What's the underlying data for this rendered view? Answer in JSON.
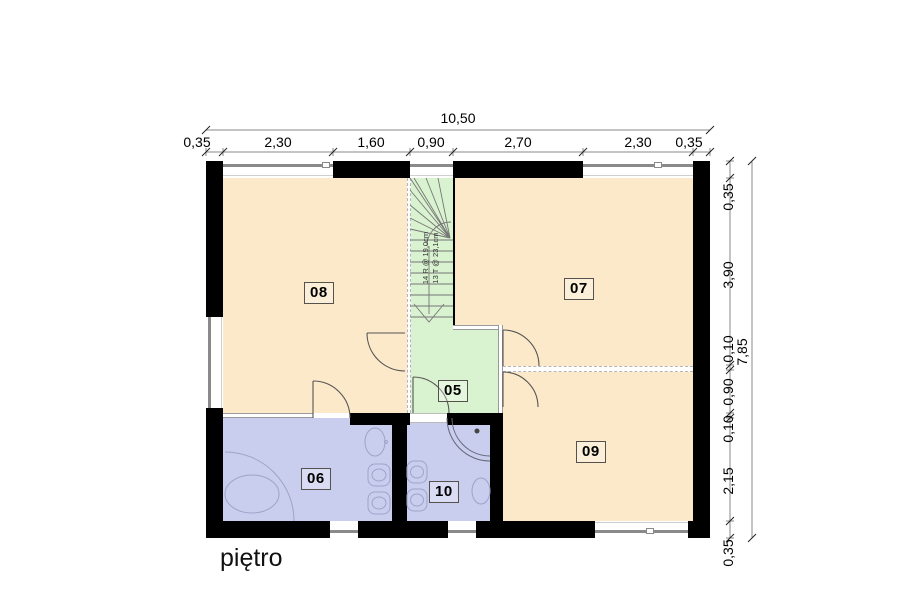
{
  "floor_label": "piętro",
  "rooms": [
    {
      "label": "08"
    },
    {
      "label": "07"
    },
    {
      "label": "05"
    },
    {
      "label": "06"
    },
    {
      "label": "10"
    },
    {
      "label": "09"
    }
  ],
  "stairs": {
    "note_line1": "14 R @ 19,0cm",
    "note_line2": "13 T @ 23,1cm"
  },
  "dimensions": {
    "top_total": "10,50",
    "top_segments": [
      "0,35",
      "2,30",
      "1,60",
      "0,90",
      "2,70",
      "2,30",
      "0,35"
    ],
    "right_total": "7,85",
    "right_segments": [
      "0,35",
      "3,90",
      "0,10",
      "0,90",
      "0,10",
      "2,15",
      "0,35"
    ]
  },
  "colors": {
    "room_peach": "#FBE9C9",
    "room_green": "#D9F2CF",
    "room_lavender": "#C9CDEE",
    "wall": "#000000",
    "window_line": "#8A8A8A",
    "door_arc": "#555555",
    "fixture_line": "#9FA3C9",
    "dim_line": "#777777",
    "dim_text": "#000000"
  }
}
